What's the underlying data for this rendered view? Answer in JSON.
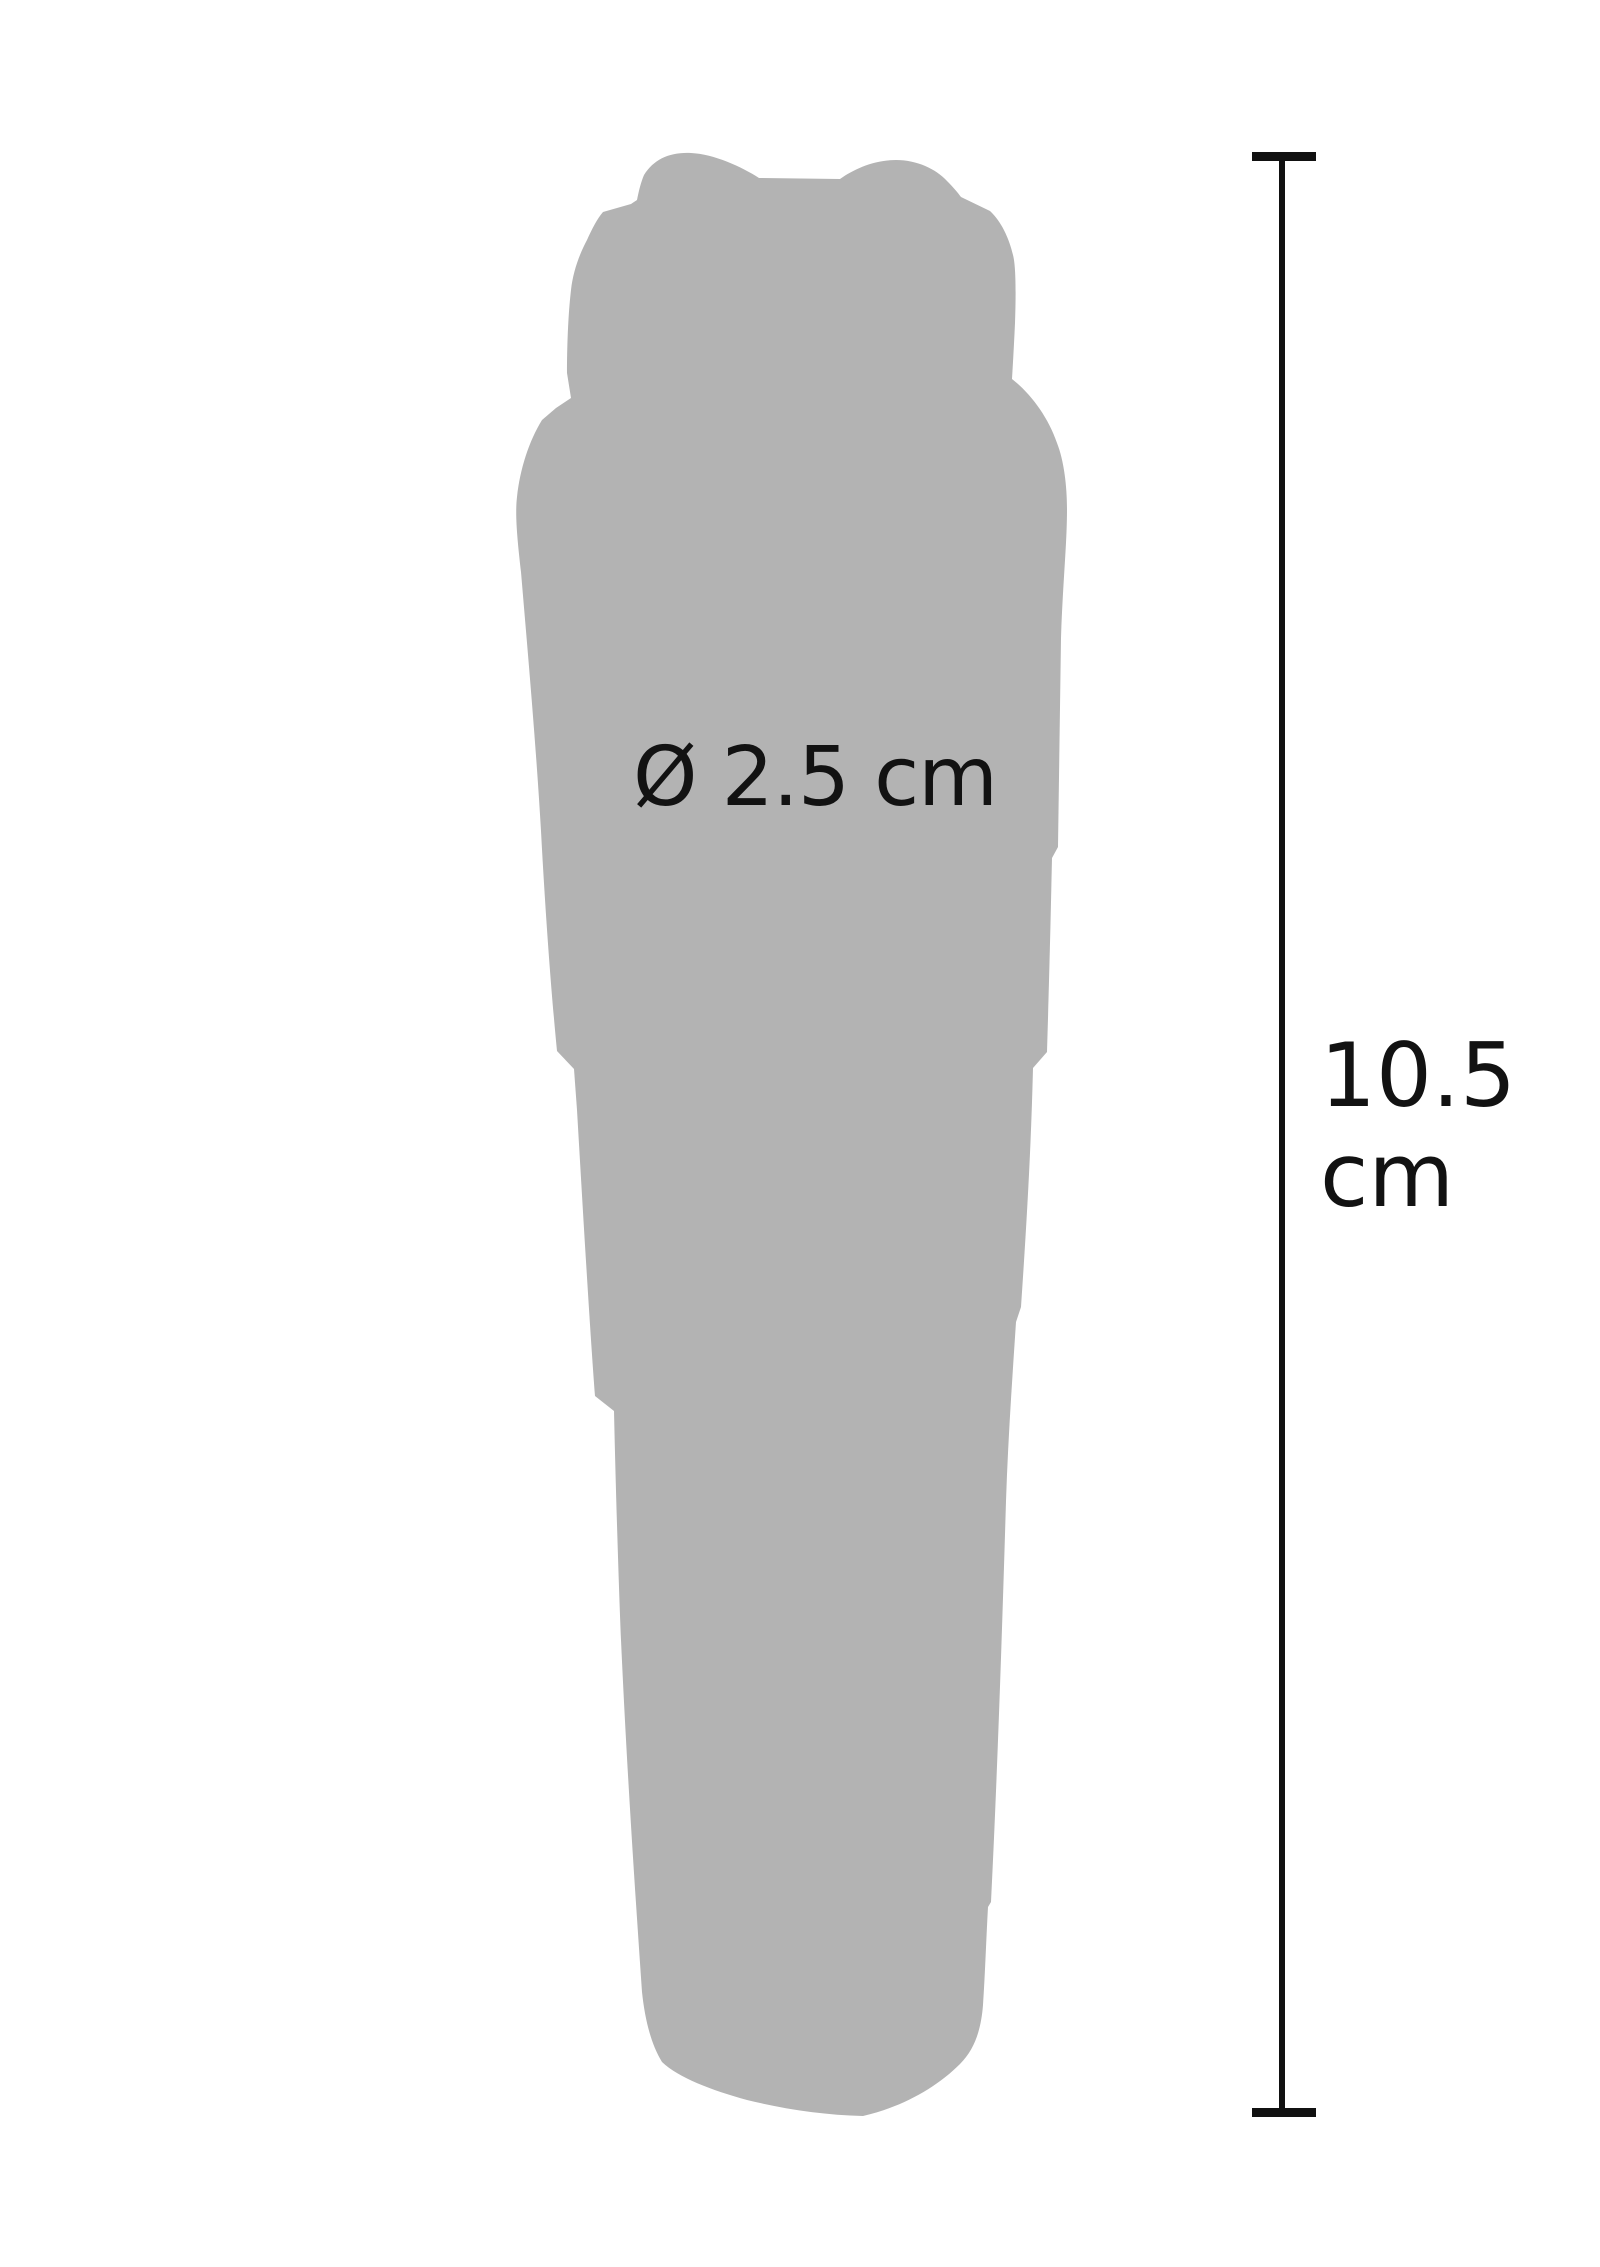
{
  "diagram": {
    "title": "product dimension diagram",
    "product": {
      "diameter_label": "Ø 2.5 cm"
    },
    "height_dimension": {
      "value": "10.5",
      "unit": "cm"
    },
    "colors": {
      "silhouette": "#b3b3b3",
      "dimension_line": "#111111",
      "text": "#121212",
      "background": "#ffffff"
    }
  }
}
